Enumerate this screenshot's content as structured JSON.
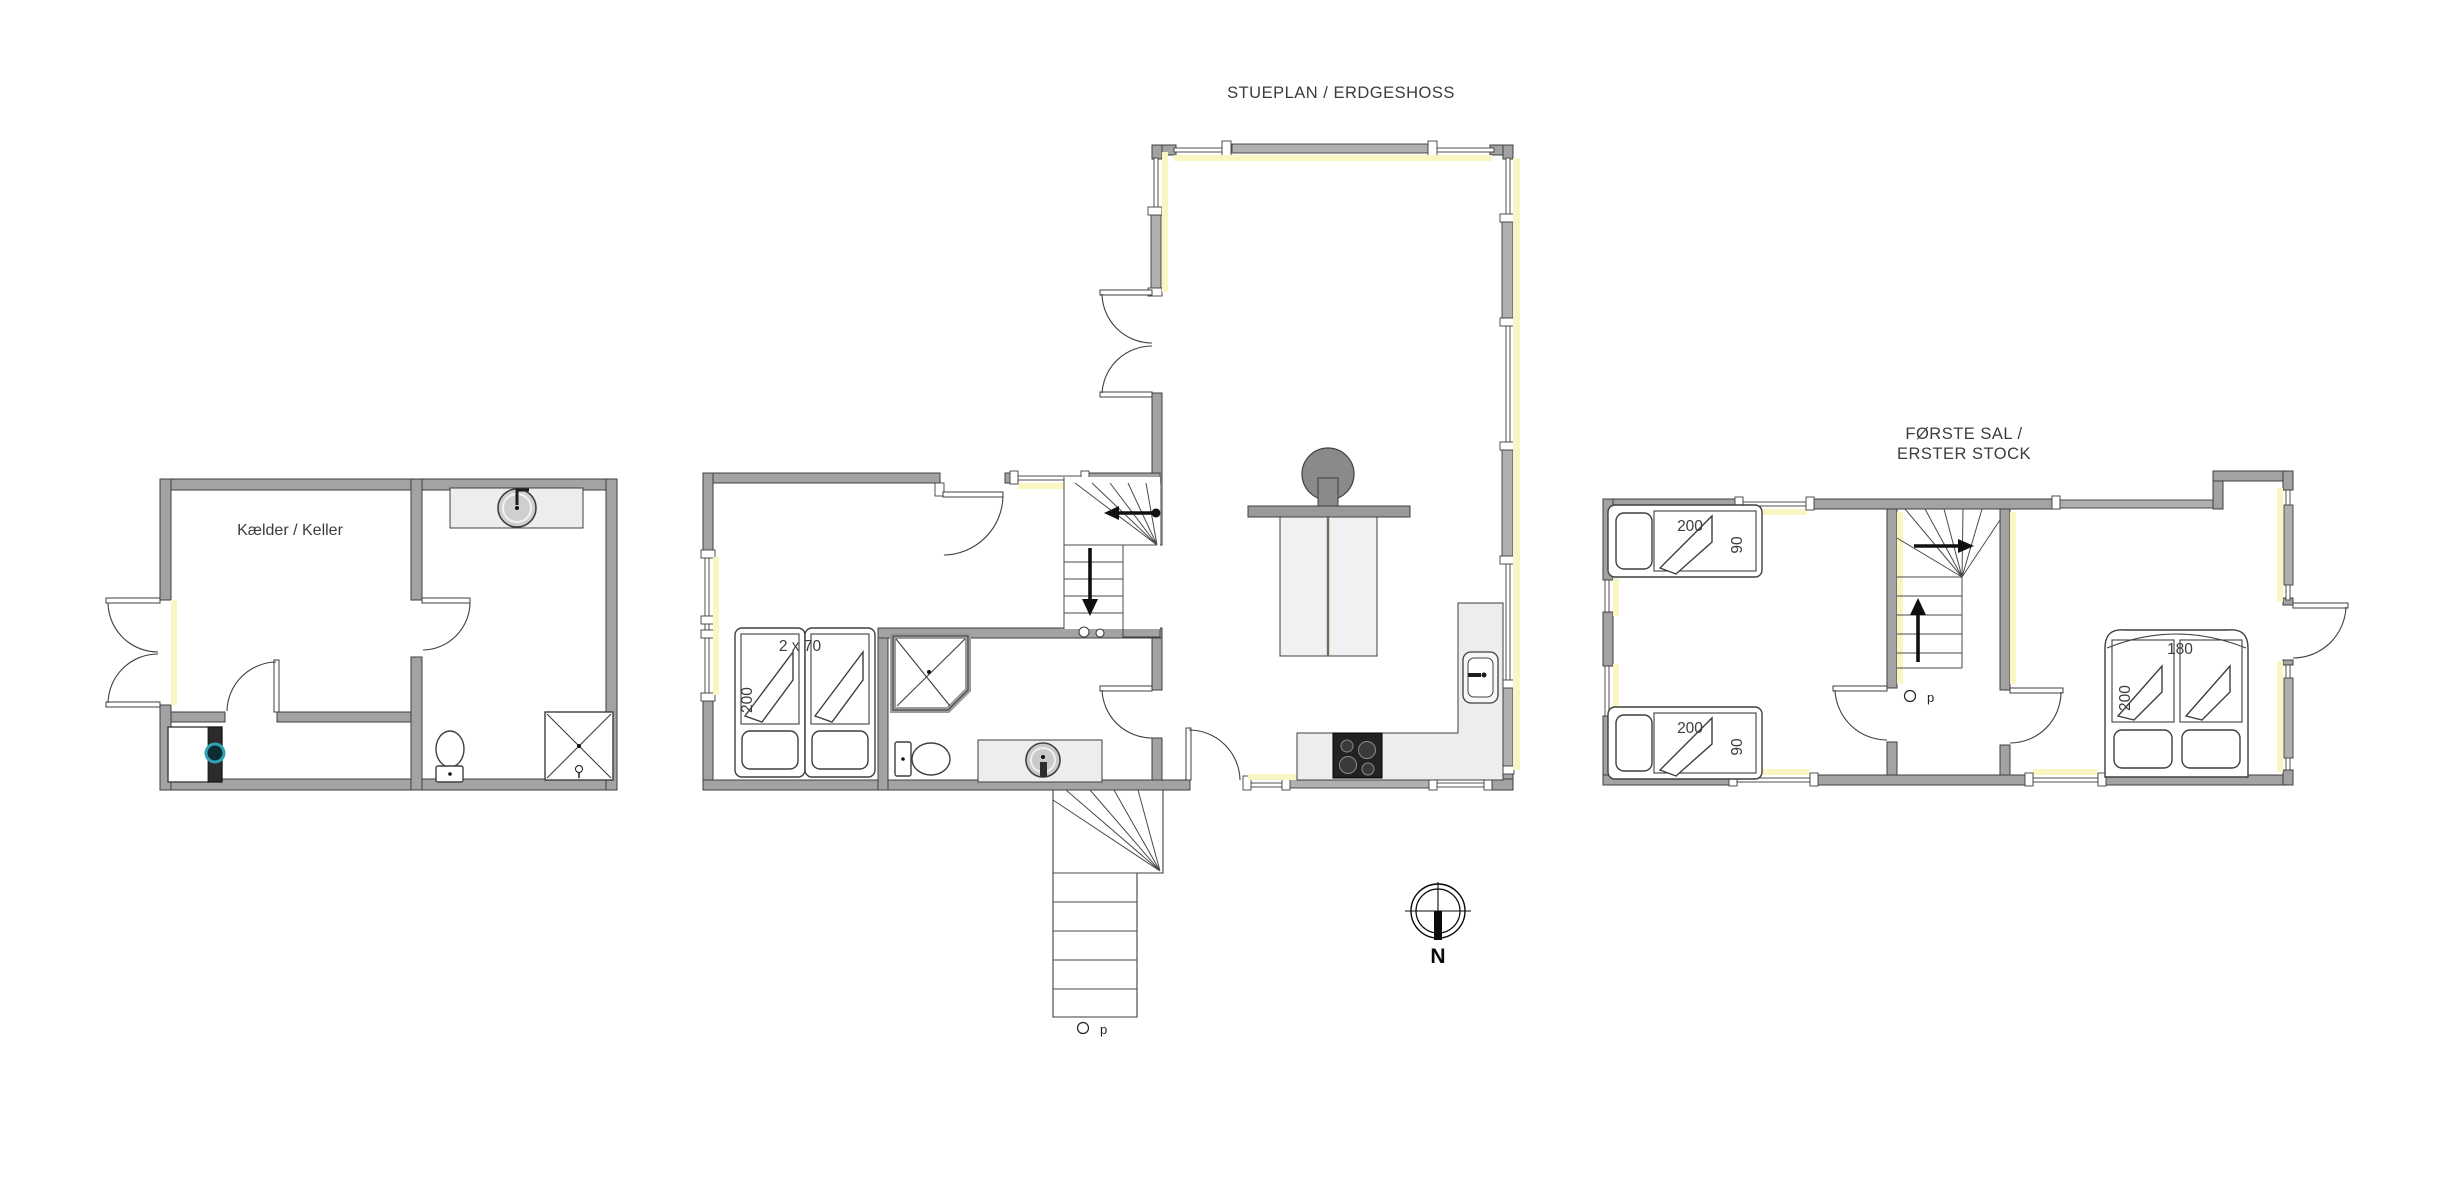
{
  "plans": {
    "basement": {
      "room_label": "Kælder / Keller"
    },
    "ground": {
      "title": "STUEPLAN / ERDGESHOSS",
      "bedroom": {
        "beds_label": "2 x 70",
        "bed_length": "200"
      },
      "stair_symbol": "p"
    },
    "first": {
      "title_line1": "FØRSTE SAL /",
      "title_line2": "ERSTER STOCK",
      "bed_top": {
        "length": "200",
        "width": "90"
      },
      "bed_bottom": {
        "length": "200",
        "width": "90"
      },
      "double_bed": {
        "width": "180",
        "length": "200"
      },
      "stair_symbol": "p"
    }
  },
  "compass": {
    "north_label": "N"
  },
  "colors": {
    "wall": "#a3a3a3",
    "wall_outline": "#3f3f3f",
    "window_glow": "#faf6c3",
    "sash": "#b0b0b0",
    "counter": "#ededed",
    "stove": "#8a8a8a",
    "cooktop": "#222222",
    "washer_door": "#2fa3b3",
    "text": "#3c3c3c"
  }
}
